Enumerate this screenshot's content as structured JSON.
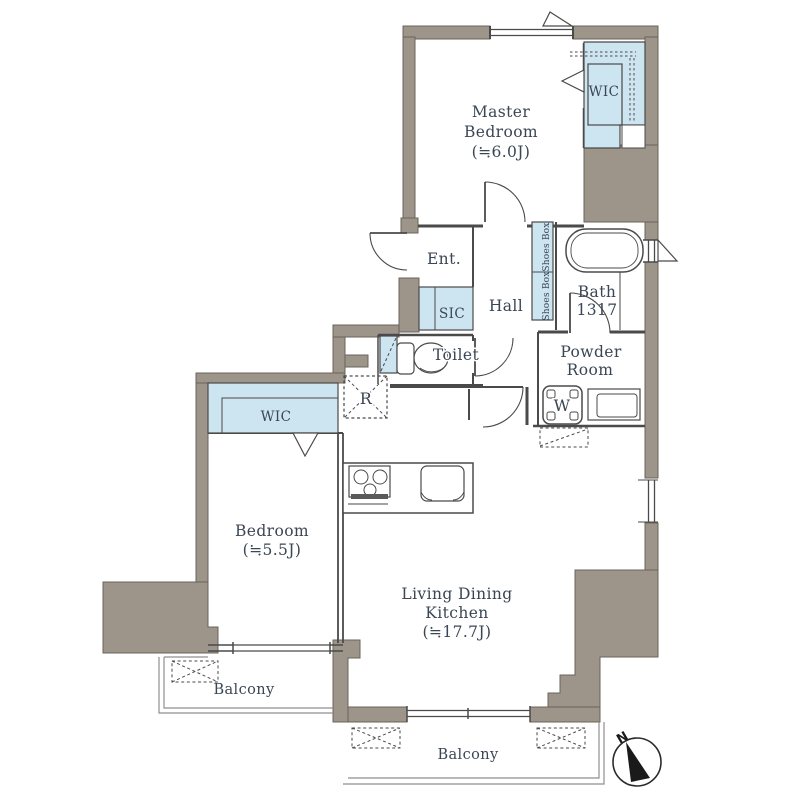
{
  "plan": {
    "labels": {
      "master_bedroom_1": "Master",
      "master_bedroom_2": "Bedroom",
      "master_bedroom_size": "(≒6.0J)",
      "wic_master": "WIC",
      "ent": "Ent.",
      "sic": "SIC",
      "hall": "Hall",
      "shoes_box_upper": "Shoes Box",
      "shoes_box_lower": "Shoes Box",
      "bath": "Bath",
      "bath_size": "1317",
      "toilet": "Toilet",
      "powder_1": "Powder",
      "powder_2": "Room",
      "washer": "W",
      "refrigerator": "R",
      "wic_bedroom": "WIC",
      "bedroom": "Bedroom",
      "bedroom_size": "(≒5.5J)",
      "ldk_1": "Living Dining",
      "ldk_2": "Kitchen",
      "ldk_size": "(≒17.7J)",
      "balcony_west": "Balcony",
      "balcony_south": "Balcony"
    },
    "compass": {
      "north": "N"
    },
    "colors": {
      "wall": "#9d948a",
      "closet_fill": "#cde4f1",
      "line": "#4a4a4a",
      "text": "#3a4654",
      "balcony_line": "#8f8f8f"
    }
  }
}
